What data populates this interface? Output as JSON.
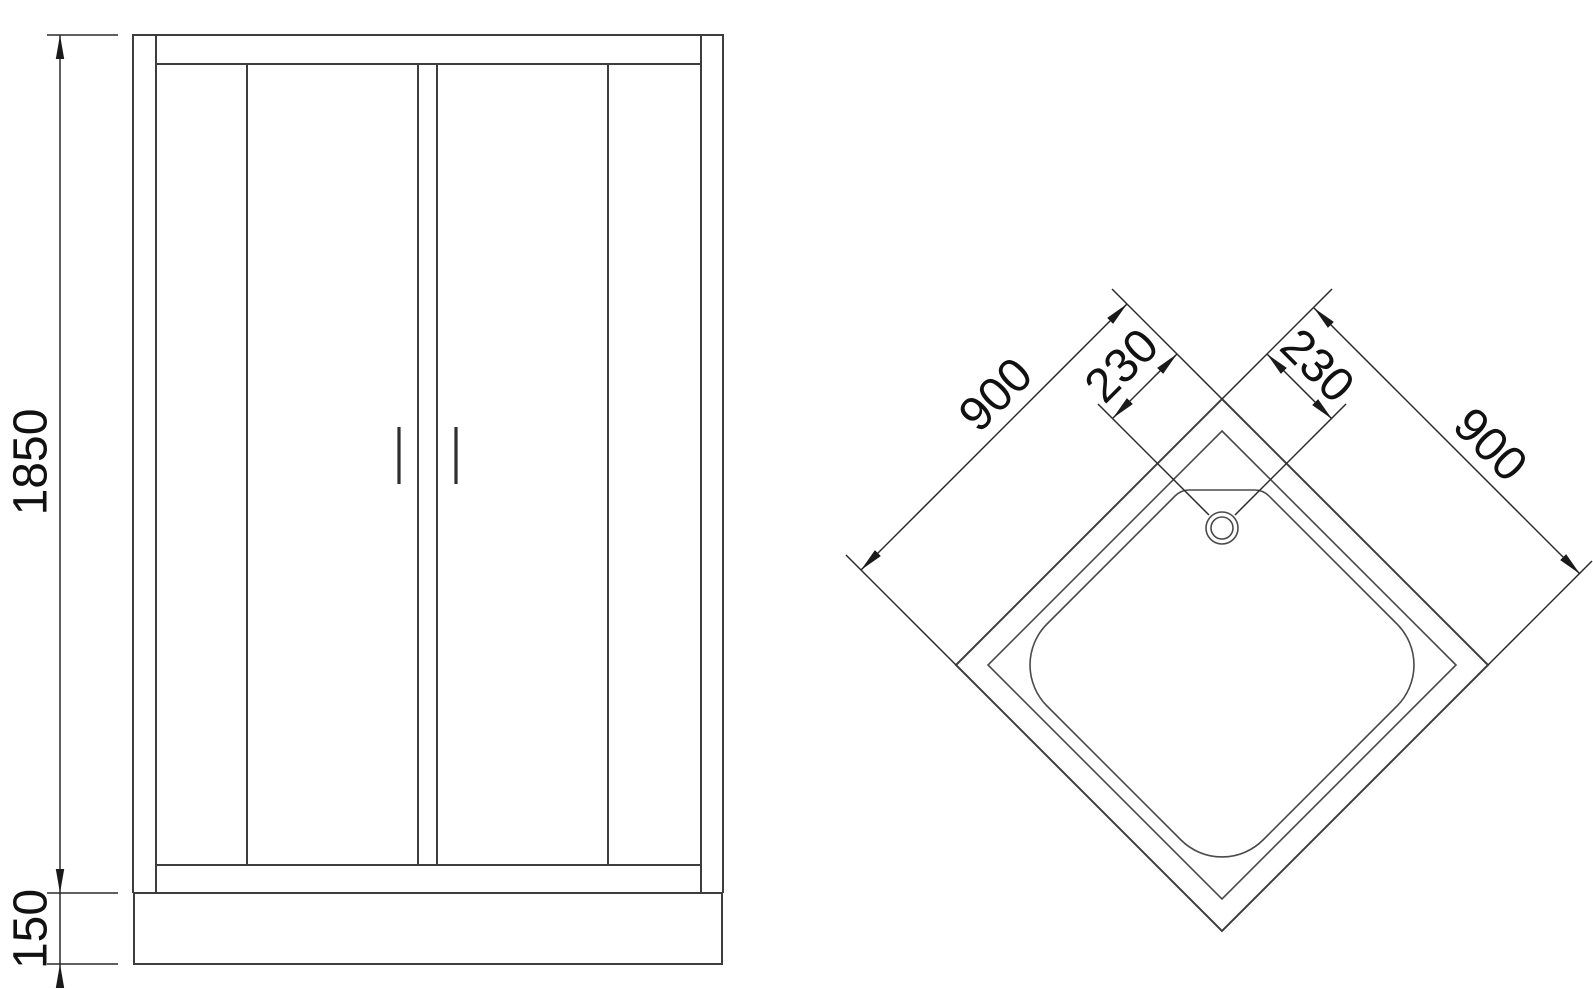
{
  "drawing": {
    "type": "shower-enclosure-technical-drawing",
    "front_view": {
      "dims": {
        "enclosure_height": "1850",
        "tray_height": "150"
      }
    },
    "plan_view": {
      "dims": {
        "edge_left": "900",
        "edge_right": "900",
        "drain_offset_left": "230",
        "drain_offset_right": "230"
      }
    },
    "colors": {
      "background": "#ffffff",
      "drawing_line": "#3d3d3d",
      "dimension_line": "#2b2b2b",
      "text": "#111111"
    }
  }
}
